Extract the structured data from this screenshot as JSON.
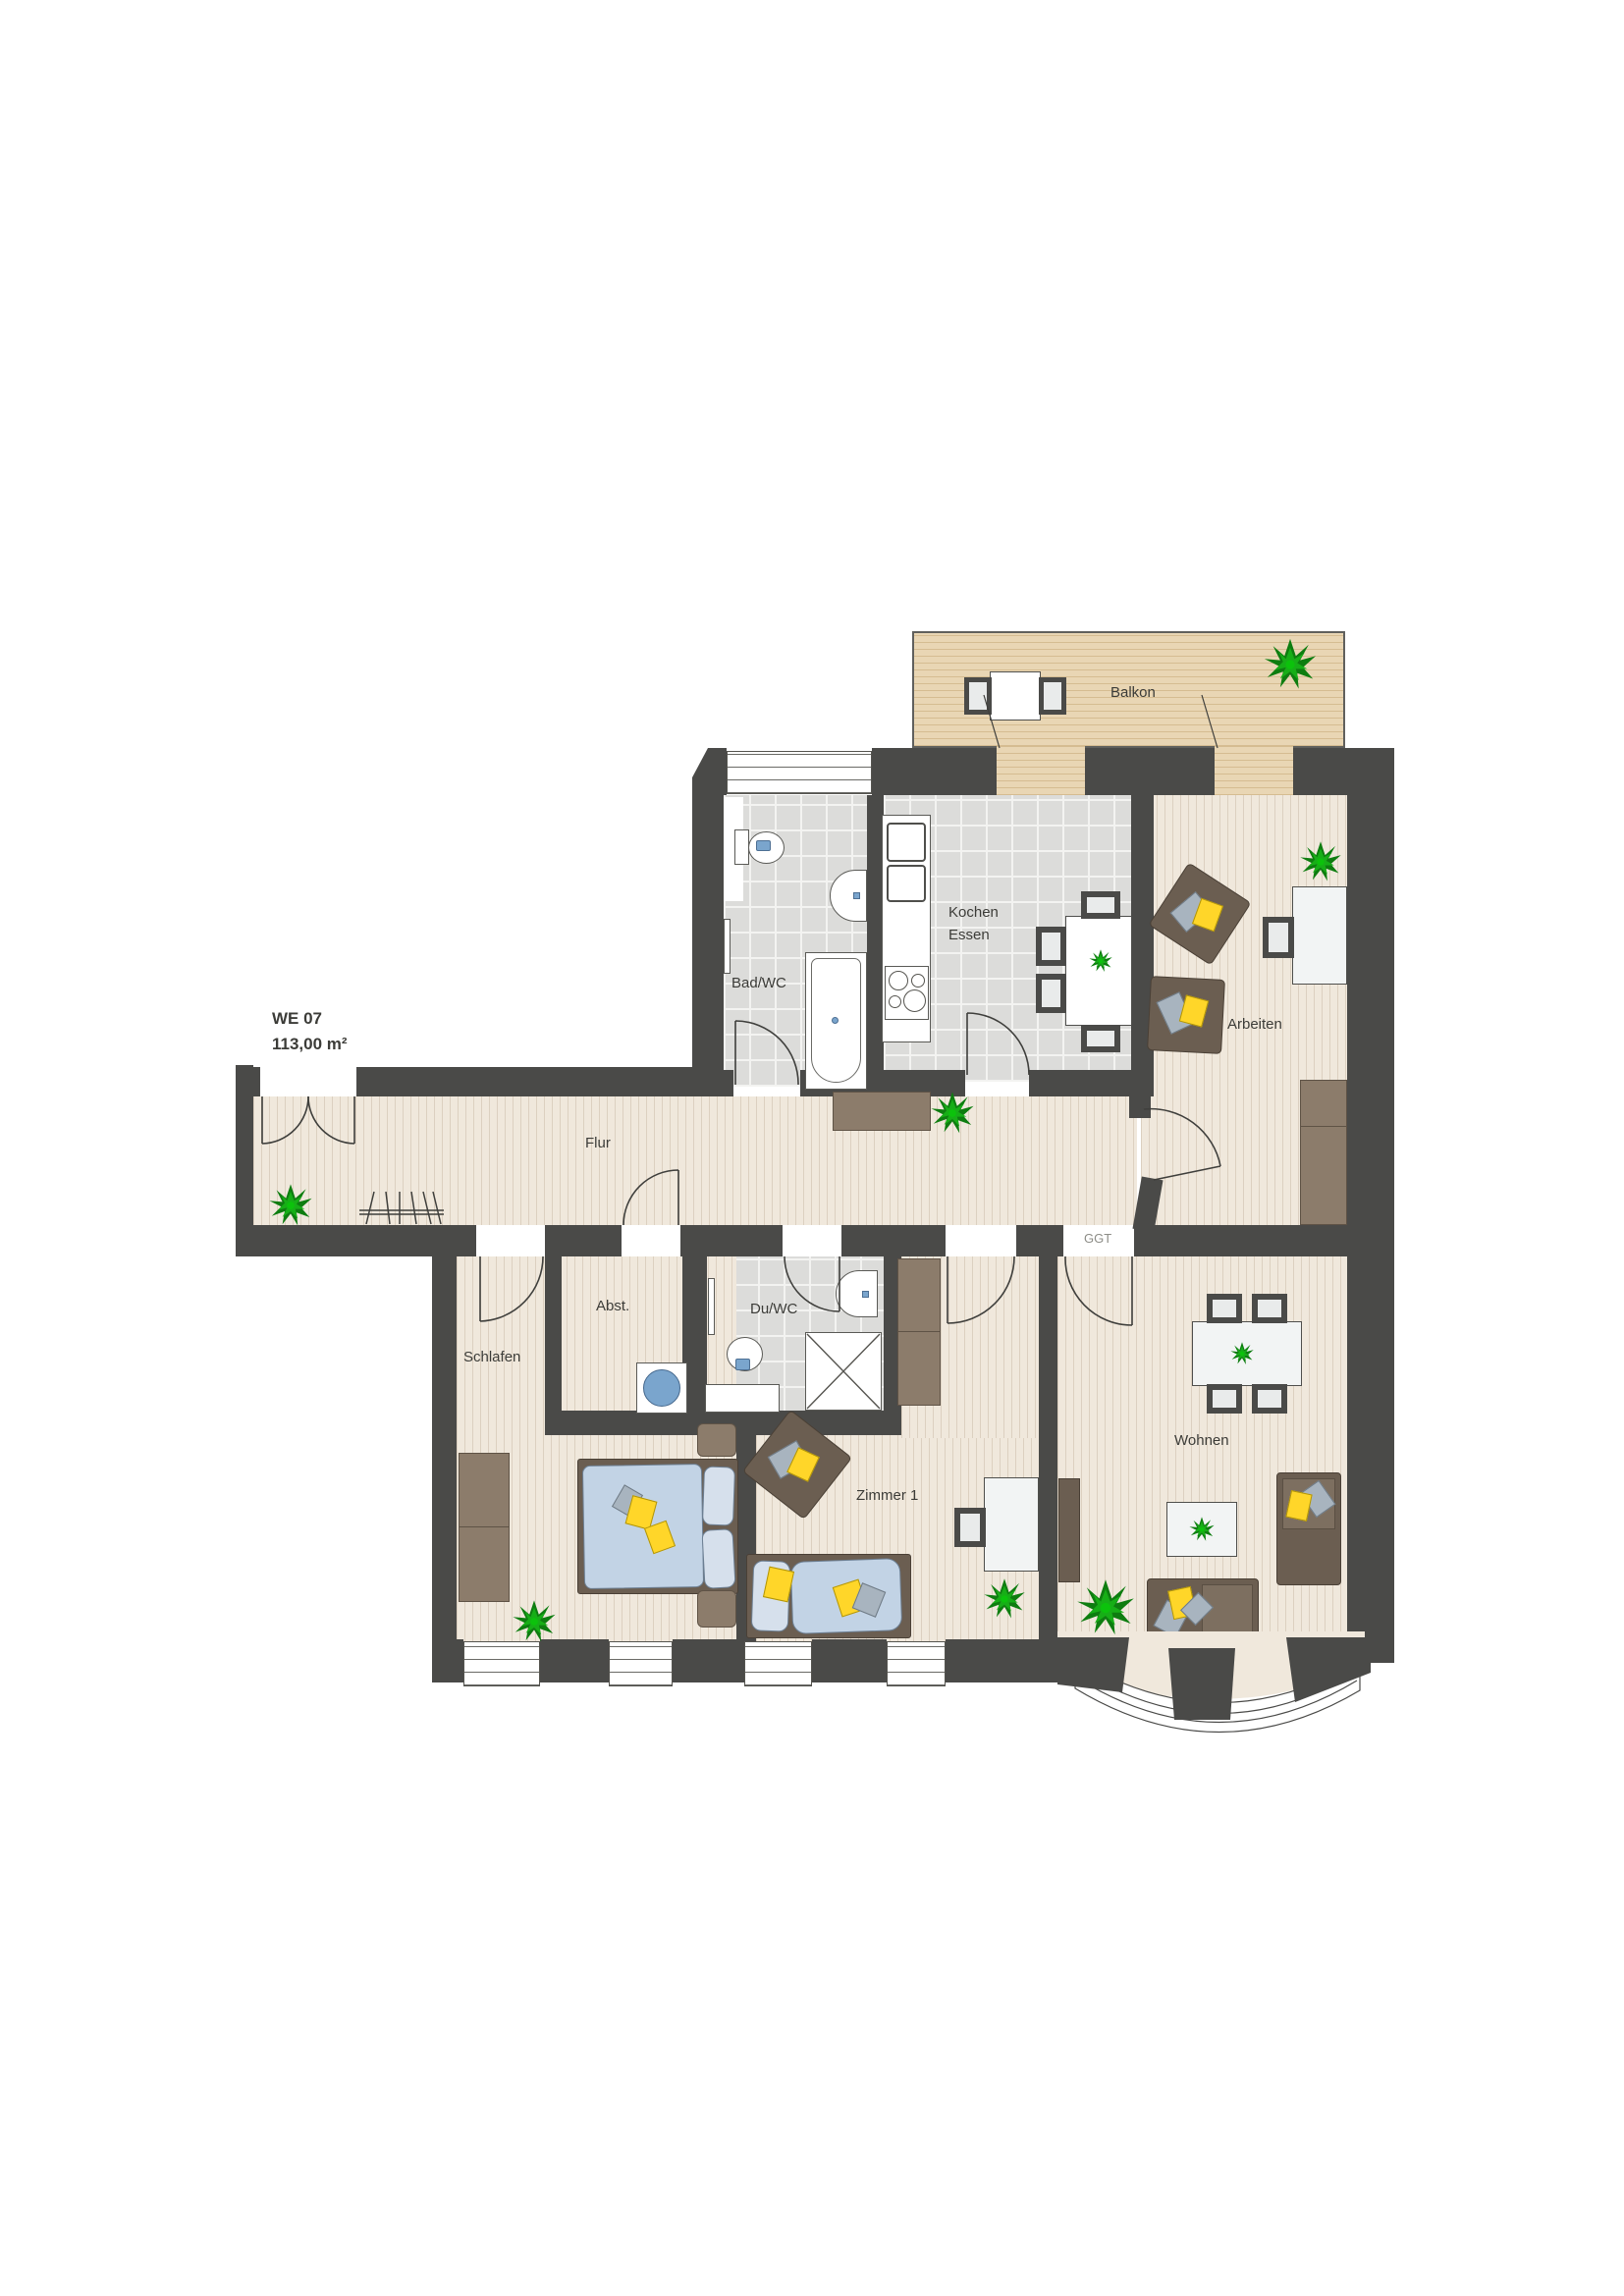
{
  "plan": {
    "unit": {
      "id_label": "WE 07",
      "area_label": "113,00 m²"
    },
    "rooms": {
      "balkon": "Balkon",
      "bad_wc": "Bad/WC",
      "kochen": "Kochen",
      "essen": "Essen",
      "arbeiten": "Arbeiten",
      "flur": "Flur",
      "abstellraum": "Abst.",
      "du_wc": "Du/WC",
      "schlafen": "Schlafen",
      "zimmer1": "Zimmer 1",
      "wohnen": "Wohnen"
    },
    "annotations": {
      "glass_door": "GGT"
    },
    "colors": {
      "wall": "#4a4a48",
      "wood_floor": "#f0e8dc",
      "tile_floor": "#dcdcda",
      "balcony_deck": "#e9d6b4",
      "furniture_brown": "#6b5e51",
      "sideboard_brown": "#8c7c6b",
      "bedding_blue": "#c2d3e5",
      "cushion_yellow": "#ffd629",
      "cushion_gray": "#a8b4bf",
      "washer_blue": "#7aa5cd",
      "plant_green": "#17ae17"
    }
  }
}
